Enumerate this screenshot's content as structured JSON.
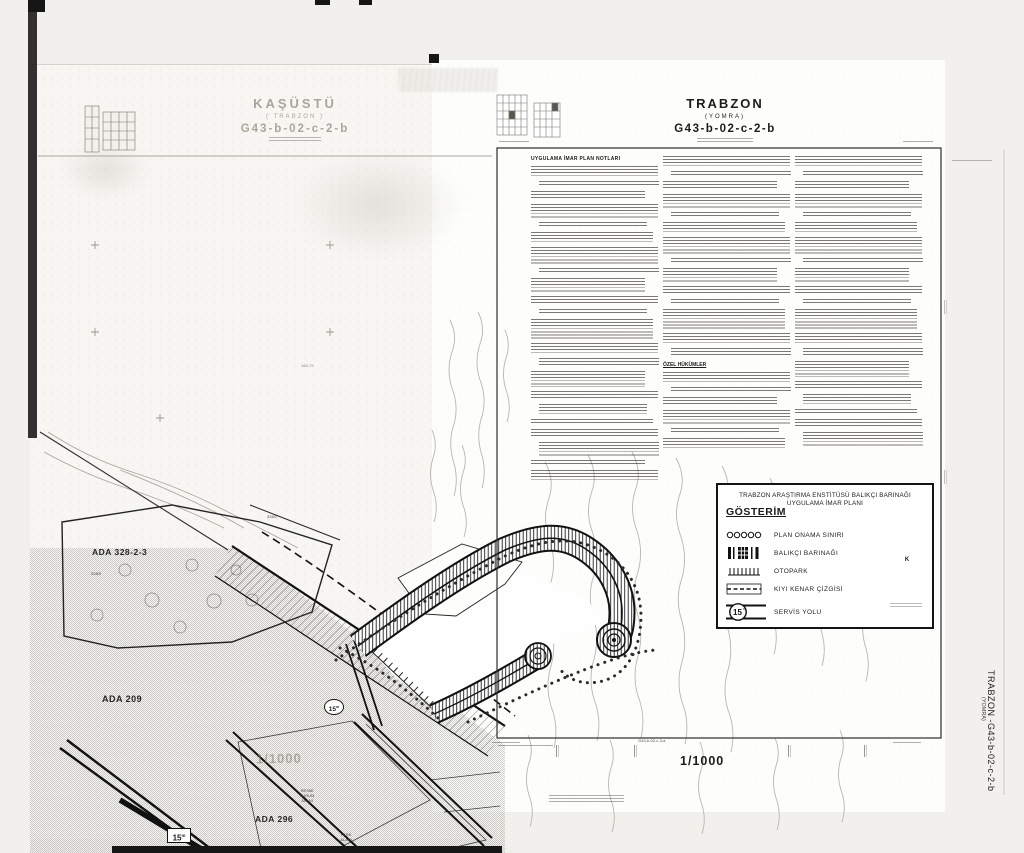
{
  "colors": {
    "paper_left": "#f7f6f2",
    "paper_right": "#fdfdfb",
    "ink": "#1b1b1b",
    "faded_ink": "#aaa59c",
    "contour": "#b8b6b0"
  },
  "left_sheet": {
    "title": "KAŞÜSTÜ",
    "region": "( TRABZON )",
    "sheet_no": "G43-b-02-c-2-b",
    "scale": "1/1000",
    "grid_ref": "165-79",
    "labels": {
      "ada_328": "ADA 328-2-3",
      "ada_209": "ADA 209",
      "ada_296": "ADA 296",
      "parcel_328_2": "328/2",
      "parcel_328_3": "328/3",
      "park_line1": "PARK",
      "park_line2": "ALANI",
      "kurum_line1": "RESMİ",
      "kurum_line2": "KURUM",
      "kurum_line3": "ALANI",
      "road_width": "15",
      "road_width_unit": "m"
    }
  },
  "right_sheet": {
    "title": "TRABZON",
    "region": "(YOMRA)",
    "sheet_no": "G43-b-02-c-2-b",
    "scale": "1/1000",
    "adjacent_sheet": "G43-b-02-c-3-a",
    "notes_heading": "UYGULAMA İMAR PLAN NOTLARI",
    "special_heading": "ÖZEL HÜKÜMLER",
    "harbor_road_width": "15",
    "harbor_road_width_unit": "m"
  },
  "legend": {
    "title_line1": "TRABZON ARAŞTIRMA ENSTİTÜSÜ BALIKÇI BARINAĞI",
    "title_line2": "UYGULAMA İMAR PLANI",
    "heading": "GÖSTERİM",
    "items": [
      {
        "label": "PLAN ONAMA SINIRI"
      },
      {
        "label": "BALIKÇI BARINAĞI"
      },
      {
        "label": "OTOPARK"
      },
      {
        "label": "KIYI KENAR ÇİZGİSİ"
      },
      {
        "label": "SERVİS YOLU"
      }
    ],
    "servis_value": "15",
    "servis_unit": "m",
    "compass_north": "K"
  },
  "edge_label": {
    "text": "TRABZON -G43-b-02-c-2-b",
    "region": "(YOMRA)"
  }
}
